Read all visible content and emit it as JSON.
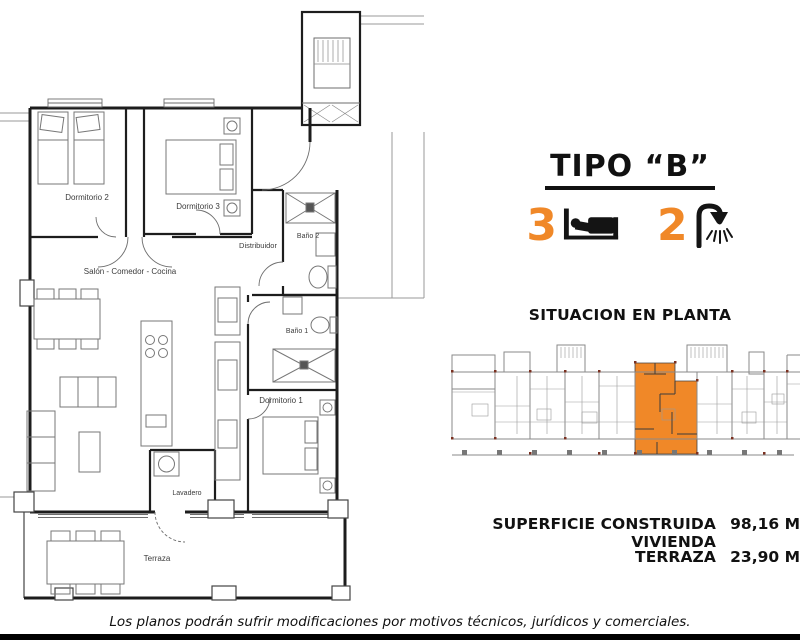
{
  "colors": {
    "accent_orange": "#F08828",
    "wall_black": "#1d1d1d",
    "situation_grey": "#8a8a8a"
  },
  "floor_plan": {
    "room_labels": {
      "dormitorio2": "Dormitorio 2",
      "dormitorio3": "Dormitorio 3",
      "bano2": "Baño 2",
      "distribuidor": "Distribuidor",
      "salon": "Salón - Comedor - Cocina",
      "bano1": "Baño 1",
      "dormitorio1": "Dormitorio 1",
      "lavadero": "Lavadero",
      "terraza": "Terraza"
    }
  },
  "info_panel": {
    "type_title": "TIPO “B”",
    "bedrooms_count": "3",
    "bathrooms_count": "2",
    "icons": {
      "bedrooms": "bed-icon",
      "bathrooms": "shower-icon"
    },
    "situation_title": "SITUACION EN PLANTA",
    "areas": [
      {
        "label": "SUPERFICIE CONSTRUIDA VIVIENDA",
        "value": "98,16 M"
      },
      {
        "label": "TERRAZA",
        "value": "23,90 M"
      }
    ]
  },
  "footer": {
    "disclaimer": "Los planos podrán sufrir modificaciones por motivos técnicos, jurídicos y comerciales."
  }
}
